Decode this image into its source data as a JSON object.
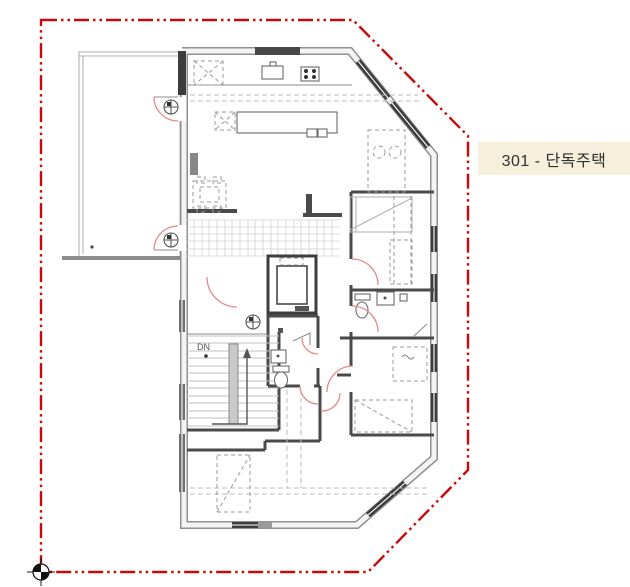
{
  "plan": {
    "unit_label": "301 - 단독주택",
    "stair_direction_label": "DN"
  },
  "colors": {
    "site_boundary": "#c90808",
    "door_swing": "#e48989",
    "wall_light": "#8f8f8f",
    "wall_dark": "#3d3d3d",
    "label_background": "#f6efdb",
    "label_text": "#2f2f2f",
    "canvas": "#ffffff"
  },
  "icons": {
    "survey_benchmark_icon": "circle-crosshair",
    "floor_drain_icon": "circle-cross"
  }
}
